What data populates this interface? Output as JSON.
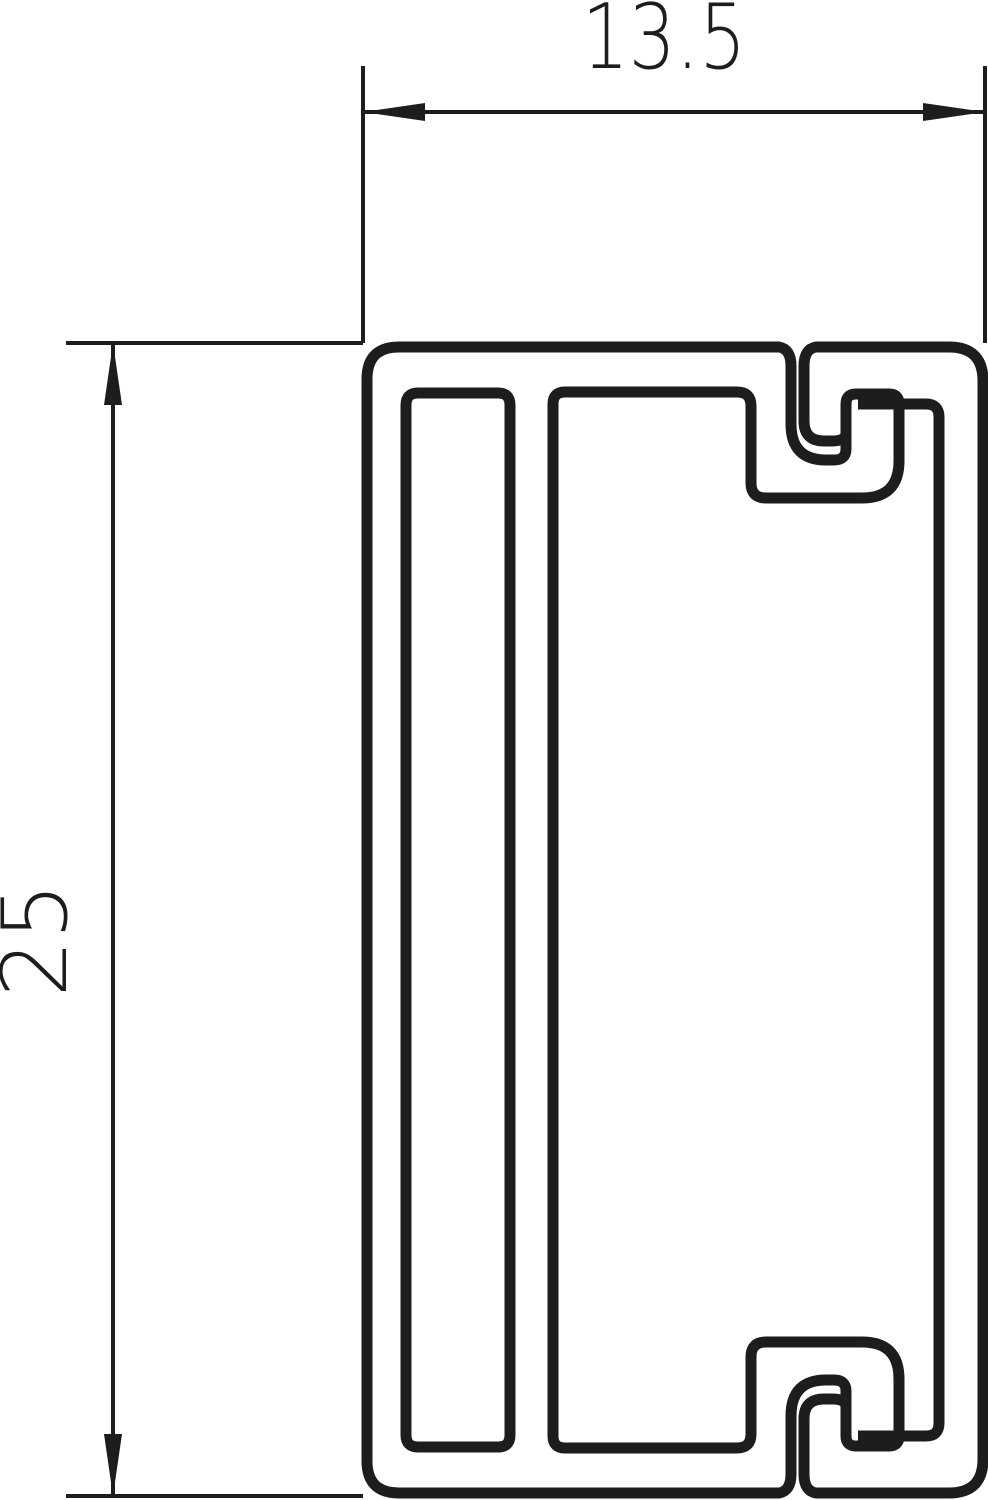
{
  "drawing": {
    "kind": "technical-cross-section",
    "subject": "mini-trunking-profile-with-snap-on-cover",
    "dimension_labels": {
      "width": "13.5",
      "height": "25"
    },
    "colors": {
      "line": "#1d1d1b",
      "background": "#ffffff"
    }
  }
}
